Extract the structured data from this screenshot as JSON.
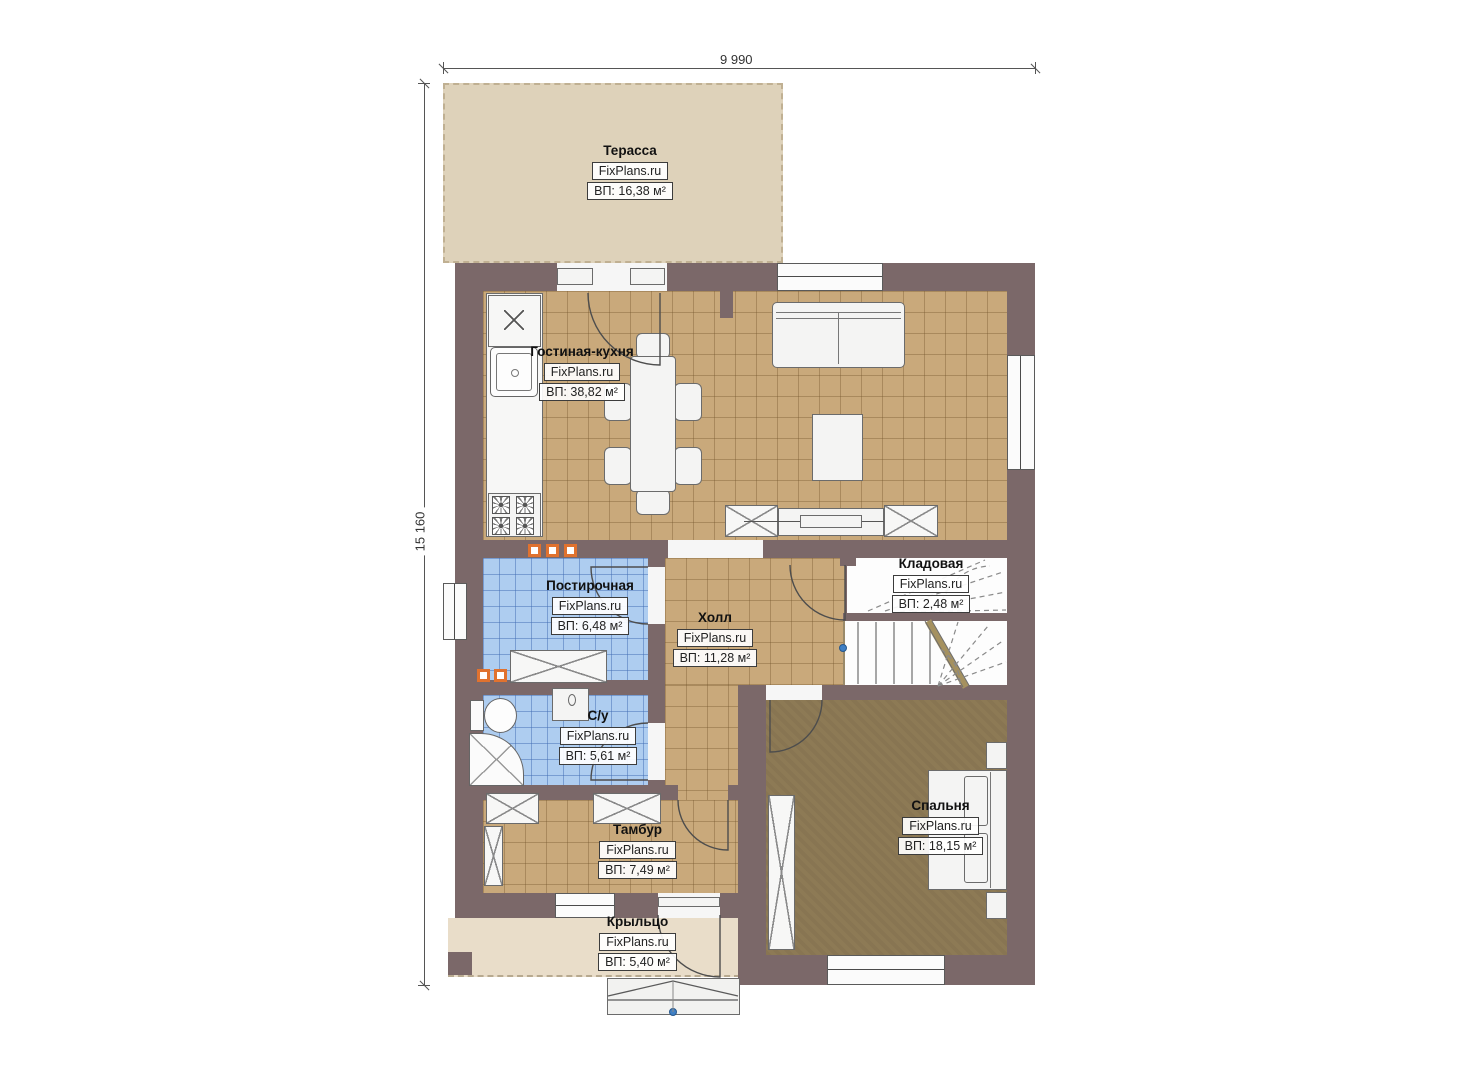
{
  "watermark": "FixPlans.ru",
  "dimensions": {
    "width_label": "9 990",
    "height_label": "15 160"
  },
  "rooms": [
    {
      "key": "terrace",
      "name": "Терасса",
      "area": "ВП: 16,38 м²"
    },
    {
      "key": "living_kitchen",
      "name": "Гостиная-кухня",
      "area": "ВП: 38,82 м²"
    },
    {
      "key": "laundry",
      "name": "Постирочная",
      "area": "ВП: 6,48 м²"
    },
    {
      "key": "hall",
      "name": "Холл",
      "area": "ВП: 11,28 м²"
    },
    {
      "key": "storage",
      "name": "Кладовая",
      "area": "ВП: 2,48 м²"
    },
    {
      "key": "bathroom",
      "name": "С/у",
      "area": "ВП: 5,61 м²"
    },
    {
      "key": "vestibule",
      "name": "Тамбур",
      "area": "ВП: 7,49 м²"
    },
    {
      "key": "bedroom",
      "name": "Спальня",
      "area": "ВП: 18,15 м²"
    },
    {
      "key": "porch",
      "name": "Крыльцо",
      "area": "ВП: 5,40 м²"
    }
  ],
  "colors": {
    "wall": "#7b6869",
    "floor_tile": "#c9a97b",
    "floor_wet": "#aecdf0",
    "floor_bedroom": "#8d7a55",
    "terrace": "#ded2ba",
    "porch": "#e9ddc9",
    "accent_marker": "#e0722f",
    "anchor_dot": "#3f7fc4"
  }
}
